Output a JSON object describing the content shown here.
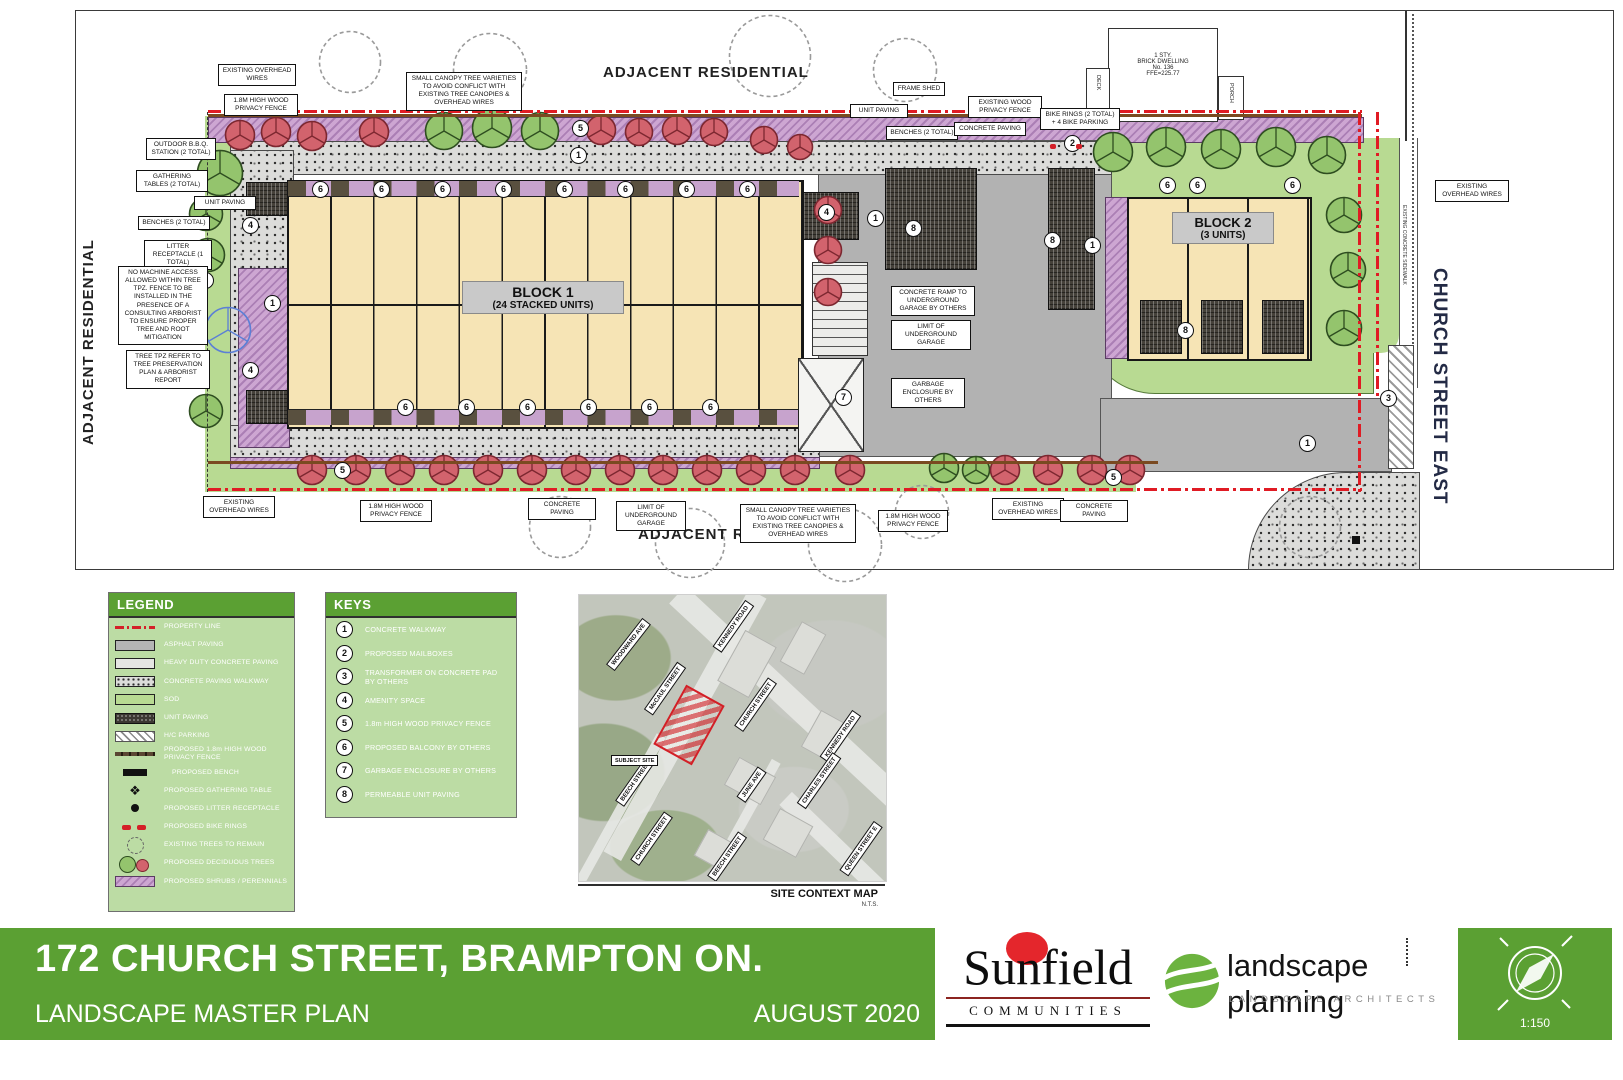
{
  "plan": {
    "area_labels": {
      "adjacent_residential": "ADJACENT RESIDENTIAL",
      "church_street_east": "CHURCH STREET EAST",
      "existing_concrete_sidewalk": "EXISTING CONCRETE SIDEWALK"
    },
    "blocks": {
      "block1_title": "BLOCK 1",
      "block1_subtitle": "(24 STACKED UNITS)",
      "block2_title": "BLOCK 2",
      "block2_subtitle": "(3 UNITS)"
    },
    "dwelling": {
      "label": "1 STY.\nBRICK DWELLING\nNo. 136\nFFE=225.77",
      "deck": "DECK",
      "porch": "PORCH"
    },
    "annotations": {
      "existing_overhead_wires": "EXISTING OVERHEAD WIRES",
      "privacy_fence": "1.8m HIGH WOOD PRIVACY FENCE",
      "small_canopy_trees": "SMALL CANOPY TREE VARIETIES TO AVOID CONFLICT WITH EXISTING TREE CANOPIES & OVERHEAD WIRES",
      "outdoor_bbq": "OUTDOOR B.B.Q. STATION (2 TOTAL)",
      "gathering_tables": "GATHERING TABLES (2 TOTAL)",
      "unit_paving": "UNIT PAVING",
      "benches": "BENCHES (2 TOTAL)",
      "litter_receptacle": "LITTER RECEPTACLE (1 TOTAL)",
      "no_machine_access": "NO MACHINE ACCESS ALLOWED WITHIN TREE TPZ. FENCE TO BE INSTALLED IN THE PRESENCE OF A CONSULTING ARBORIST TO ENSURE PROPER TREE AND ROOT MITIGATION",
      "tree_tpz": "TREE TPZ REFER TO TREE PRESERVATION PLAN & ARBORIST REPORT",
      "frame_shed": "FRAME SHED",
      "existing_wood_fence": "EXISTING WOOD PRIVACY FENCE",
      "concrete_paving": "CONCRETE PAVING",
      "bike_rings": "BIKE RINGS (2 TOTAL) + 4 BIKE PARKING",
      "concrete_ramp": "CONCRETE RAMP TO UNDERGROUND GARAGE BY OTHERS",
      "limit_garage": "LIMIT OF UNDERGROUND GARAGE",
      "garbage_enclosure": "GARBAGE ENCLOSURE BY OTHERS"
    }
  },
  "legend": {
    "title": "LEGEND",
    "items": [
      {
        "swatch": "property-line",
        "label": "PROPERTY LINE"
      },
      {
        "swatch": "asphalt",
        "label": "ASPHALT PAVING"
      },
      {
        "swatch": "heavy-concrete",
        "label": "HEAVY DUTY CONCRETE PAVING"
      },
      {
        "swatch": "walkway",
        "label": "CONCRETE PAVING WALKWAY"
      },
      {
        "swatch": "sod",
        "label": "SOD"
      },
      {
        "swatch": "unit-paving",
        "label": "UNIT PAVING"
      },
      {
        "swatch": "hc-parking",
        "label": "H/C PARKING"
      },
      {
        "swatch": "privacy-fence",
        "label": "PROPOSED 1.8m HIGH WOOD PRIVACY FENCE"
      },
      {
        "swatch": "bench",
        "label": "PROPOSED BENCH"
      },
      {
        "swatch": "gathering-table",
        "label": "PROPOSED GATHERING TABLE"
      },
      {
        "swatch": "litter",
        "label": "PROPOSED LITTER RECEPTACLE"
      },
      {
        "swatch": "bike-rings",
        "label": "PROPOSED BIKE RINGS"
      },
      {
        "swatch": "existing-tree",
        "label": "EXISTING TREES TO REMAIN"
      },
      {
        "swatch": "proposed-trees",
        "label": "PROPOSED DECIDUOUS TREES"
      },
      {
        "swatch": "shrubs",
        "label": "PROPOSED SHRUBS / PERENNIALS"
      }
    ]
  },
  "keys": {
    "title": "KEYS",
    "items": [
      {
        "num": "1",
        "label": "CONCRETE WALKWAY"
      },
      {
        "num": "2",
        "label": "PROPOSED MAILBOXES"
      },
      {
        "num": "3",
        "label": "TRANSFORMER ON CONCRETE PAD BY OTHERS"
      },
      {
        "num": "4",
        "label": "AMENITY SPACE"
      },
      {
        "num": "5",
        "label": "1.8m HIGH WOOD PRIVACY FENCE"
      },
      {
        "num": "6",
        "label": "PROPOSED BALCONY BY OTHERS"
      },
      {
        "num": "7",
        "label": "GARBAGE ENCLOSURE BY OTHERS"
      },
      {
        "num": "8",
        "label": "PERMEABLE UNIT PAVING"
      }
    ]
  },
  "context_map": {
    "caption": "SITE CONTEXT MAP",
    "scale_note": "N.T.S.",
    "subject_site": "SUBJECT SITE",
    "streets": [
      {
        "name": "WOODWARD AVE"
      },
      {
        "name": "KENNEDY ROAD"
      },
      {
        "name": "McCAUL STREET"
      },
      {
        "name": "CHURCH STREET"
      },
      {
        "name": "KENNEDY ROAD"
      },
      {
        "name": "BEECH STREET"
      },
      {
        "name": "JUNE AVE"
      },
      {
        "name": "CHARLES STREET"
      },
      {
        "name": "CHURCH STREET"
      },
      {
        "name": "BEECH STREET"
      },
      {
        "name": "QUEEN STREET E"
      }
    ]
  },
  "footer": {
    "title": "172 CHURCH STREET, BRAMPTON ON.",
    "subtitle": "LANDSCAPE MASTER PLAN",
    "date": "AUGUST 2020",
    "scale": "1:150",
    "sunfield_name": "Sunfield",
    "sunfield_sub": "COMMUNITIES",
    "lp_name": "landscape planning",
    "lp_sub": "LANDSCAPE ARCHITECTS"
  },
  "colors": {
    "brand_green": "#5ba033",
    "legend_bg": "#bcdca4",
    "building_tan": "#f6e4b5",
    "planting_purple": "#c7a3cd",
    "tree_red": "#d2636d",
    "tree_green": "#94c46d",
    "sod_green": "#b8da92",
    "asphalt_gray": "#b2b2b2",
    "property_line_red": "#e01b24"
  }
}
